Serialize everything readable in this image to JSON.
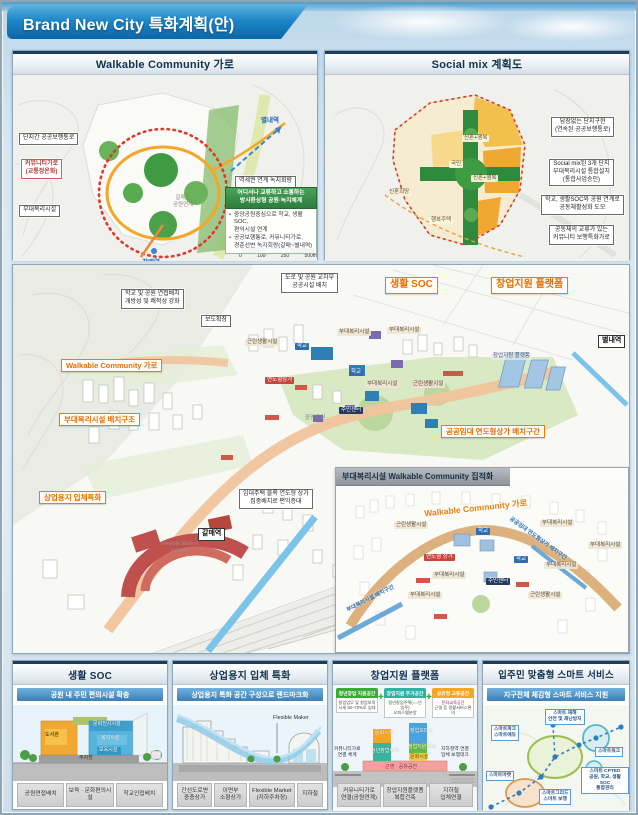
{
  "header": {
    "title": "Brand New City 특화계획(안)"
  },
  "walkable": {
    "title": "Walkable Community 가로",
    "callouts": {
      "c1": "단지간 공공보행통로",
      "c2": "커뮤니티가로\n(교통정온화)",
      "c3": "부대복리시설",
      "c4": "역세권 연계 녹지회랑"
    },
    "stations": {
      "byeollae": "별내역",
      "galmae": "갈매역"
    },
    "notes": {
      "stream": "갈매천\n공원연계"
    },
    "infobox": {
      "title": "어디서나 교류하고 소통하는\n방사환상형 공원·녹지체계",
      "bullets": [
        "중앙공원중심으로 학교, 생활 SOC,\n편익시설 연계",
        "공공보행통로, 커뮤니티가로,\n경춘선변 녹지회랑(갈매~별내역)"
      ]
    },
    "scale_ticks": [
      "0",
      "100",
      "250",
      "500m"
    ]
  },
  "socialmix": {
    "title": "Social mix 계획도",
    "callouts": {
      "c1": "담장없는 단지구현\n(연속된 공공보행통로)",
      "c2": "Social mix된 3개 단지\n부대복리시설 통합설치\n(통합사업승인)",
      "c3": "학교, 생활SOC와 공원 연계로\n공동체활성화 도모",
      "c4": "공동체의 교류가 있는\n커뮤니티 보행특화가로"
    },
    "map_labels": {
      "mix1": "신혼+행복",
      "mix2": "신혼+행복",
      "gukmin": "국민",
      "shinhon": "신혼희망",
      "haengbok": "행복주택"
    }
  },
  "mainmap": {
    "orange": {
      "walkable": "Walkable Community 가로",
      "soc": "생활 SOC",
      "startup": "창업지원 플랫폼",
      "budae": "부대복리시설 배치구조",
      "sangup": "상업용지 입체특화",
      "gonggong": "공공임대 연도형상가 배치구간"
    },
    "white": {
      "school": "학교 및 공원 연접배치\n개방성 및 쾌적성 강화",
      "sidewalk": "보도확장",
      "cross": "도로 및 공원 교차부\n공공시설 배치",
      "imdae": "임대주택 블록 연도형 상가\n집중배치로 편익증대",
      "byeollae": "별내역",
      "galmae": "갈매역"
    },
    "small": {
      "geunrin1": "근린생활시설",
      "geunrin2": "근린생활시설",
      "school1": "학교",
      "school2": "학교",
      "yeondo": "연도형상가",
      "budae1": "부대복리시설",
      "budae2": "부대복리시설",
      "budae3": "부대복리시설",
      "jumin": "주민센터",
      "park": "중앙공원",
      "startup_bld": "창업지원 플랫폼",
      "market": "Flexible Market\nSquare"
    }
  },
  "inset": {
    "title": "부대복리시설 Walkable Community 집적화",
    "curve_label": "Walkable Community 가로",
    "blue1": "부대복리시설 배치구간",
    "blue2": "공공임대 연도형상가 배치구간",
    "labels": {
      "geunrin1": "근린생활시설",
      "geunrin2": "근린생활시설",
      "school1": "학교",
      "school2": "학교",
      "yeondo": "연도형 상가",
      "budae1": "부대복리시설",
      "budae2": "부대복리시설",
      "budae3": "부대복리시설",
      "budae4": "부대복리시설",
      "jumin": "주민센터"
    }
  },
  "bottom": [
    {
      "title": "생활 SOC",
      "subtitle": "공원 내 주민 편의시설 확충",
      "blocks": {
        "library": "도서관",
        "culture": "문화전시시설",
        "welfare": "복지시설",
        "childcare": "보육시설",
        "parking": "주차장"
      },
      "footer": [
        "공원연접배치",
        "보육 · 문화편의시설",
        "학교인접배치"
      ]
    },
    {
      "title": "상업용지 입체 특화",
      "subtitle": "상업용지 특화 공간 구성으로 랜드마크화",
      "maker_label": "Flexible Maker",
      "footer": [
        "간선도로변\n중층상가",
        "이면부\n소형상가",
        "Flexible Market\n(지하주차장)",
        "지하철"
      ]
    },
    {
      "title": "창업지원 플랫폼",
      "chips": [
        {
          "head": "청년창업 지원공간",
          "body": "창업업무 및 창업보육\n시세 50~70%로 임대"
        },
        {
          "head": "창업지원 주거공간",
          "body": "청년창업주택(○○년 입주)\n오피스텔분양"
        },
        {
          "head": "공유형 교류공간",
          "body": "문화교육공간\n근생 등 생활서비스편의"
        }
      ],
      "tower": {
        "t1": "문화시설",
        "t2": "청년창업주택",
        "t3": "창업오피스",
        "t4": "창업지원시설",
        "t5": "문화시설",
        "base": "근생 · 공유공간"
      },
      "side_left": "커뮤니티가로\n연결 체계",
      "side_right": "지하철역 연결\n입체 보행데크",
      "footer": [
        "커뮤니티가로\n연결(공원연계)",
        "창업지원플랫폼\n복합건축",
        "지하철\n입체연결"
      ]
    },
    {
      "title": "입주민 맞춤형 스마트 서비스",
      "subtitle": "지구전체 체감형 스마트 서비스 지원",
      "labels": {
        "disaster": "스마트 재해\n안전 및 재난방지",
        "park_edu": "스마트파크\n스마트에듀",
        "work": "스마트워크",
        "cpted": "스마트 CPTED\n공원, 학교, 생활SOC\n통합관리",
        "market": "스마트마켓",
        "grid": "스마트그리드\n스마트 보행"
      }
    }
  ]
}
